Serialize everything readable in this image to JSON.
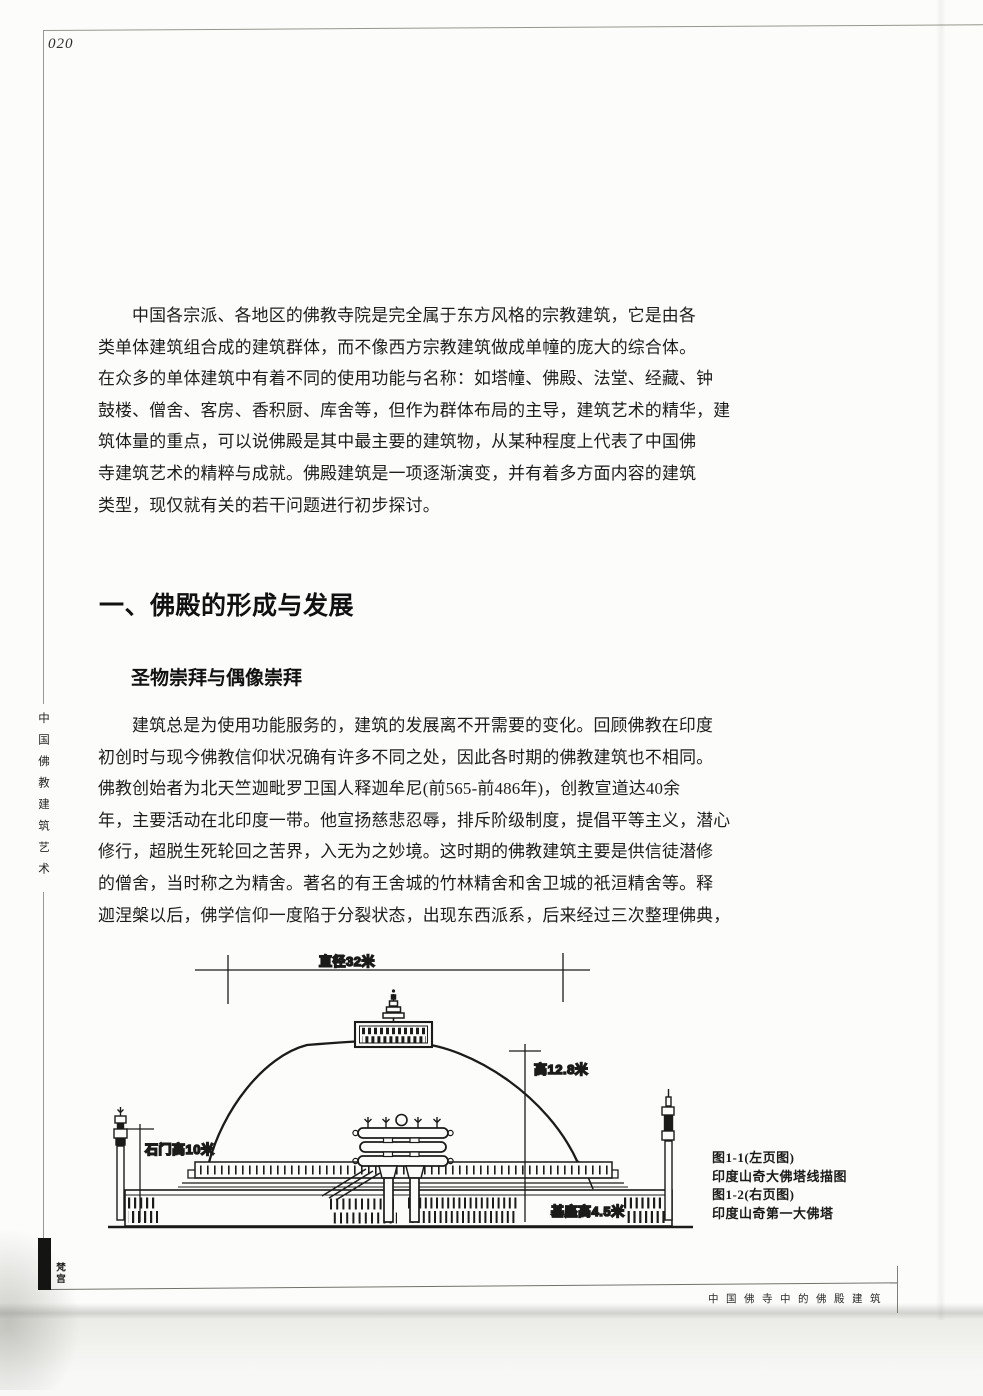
{
  "page": {
    "number": "020",
    "side_title": "中国佛教建筑艺术",
    "series_marker": "梵宫",
    "footer_title": "中国佛寺中的佛殿建筑"
  },
  "intro": {
    "lines": [
      "中国各宗派、各地区的佛教寺院是完全属于东方风格的宗教建筑，它是由各",
      "类单体建筑组合成的建筑群体，而不像西方宗教建筑做成单幢的庞大的综合体。",
      "在众多的单体建筑中有着不同的使用功能与名称：如塔幢、佛殿、法堂、经藏、钟",
      "鼓楼、僧舍、客房、香积厨、库舍等，但作为群体布局的主导，建筑艺术的精华，建",
      "筑体量的重点，可以说佛殿是其中最主要的建筑物，从某种程度上代表了中国佛",
      "寺建筑艺术的精粹与成就。佛殿建筑是一项逐渐演变，并有着多方面内容的建筑",
      "类型，现仅就有关的若干问题进行初步探讨。"
    ]
  },
  "section": {
    "heading": "一、佛殿的形成与发展",
    "subheading": "圣物崇拜与偶像崇拜",
    "lines": [
      "建筑总是为使用功能服务的，建筑的发展离不开需要的变化。回顾佛教在印度",
      "初创时与现今佛教信仰状况确有许多不同之处，因此各时期的佛教建筑也不相同。",
      "佛教创始者为北天竺迦毗罗卫国人释迦牟尼(前565-前486年)，创教宣道达40余",
      "年，主要活动在北印度一带。他宣扬慈悲忍辱，排斥阶级制度，提倡平等主义，潜心",
      "修行，超脱生死轮回之苦界，入无为之妙境。这时期的佛教建筑主要是供信徒潜修",
      "的僧舍，当时称之为精舍。著名的有王舍城的竹林精舍和舍卫城的祇洹精舍等。释",
      "迦涅槃以后，佛学信仰一度陷于分裂状态，出现东西派系，后来经过三次整理佛典，"
    ]
  },
  "figure": {
    "labels": {
      "diameter": "直径32米",
      "dome_height": "高12.8米",
      "gate_height": "石门高10米",
      "base_height": "基座高4.5米"
    },
    "caption_lines": [
      "图1-1(左页图)",
      "印度山奇大佛塔线描图",
      "图1-2(右页图)",
      "印度山奇第一大佛塔"
    ]
  }
}
